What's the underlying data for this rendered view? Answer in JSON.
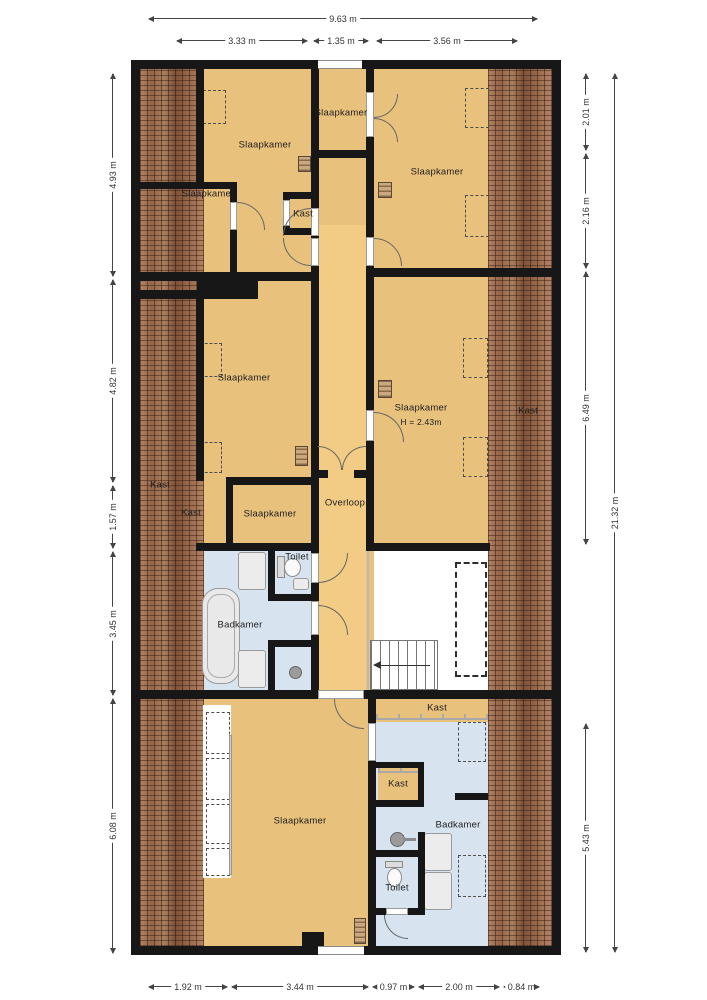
{
  "colors": {
    "wall": "#171717",
    "floor": "#e8c17c",
    "corridor": "#f2cb85",
    "bath": "#d7e4f0",
    "roof": "#96684c",
    "dim": "#444444"
  },
  "plan": {
    "labels": [
      {
        "id": "slaapkamer-top-left",
        "text": "Slaapkamer",
        "x": 265,
        "y": 145
      },
      {
        "id": "slaapkamer-top-center",
        "text": "Slaapkamer",
        "x": 341,
        "y": 113
      },
      {
        "id": "slaapkamer-top-right",
        "text": "Slaapkamer",
        "x": 437,
        "y": 172
      },
      {
        "id": "slaapkamer-left-small",
        "text": "Slaapkamer",
        "x": 208,
        "y": 194
      },
      {
        "id": "kast-top-center",
        "text": "Kast",
        "x": 303,
        "y": 214
      },
      {
        "id": "slaapkamer-mid-left",
        "text": "Slaapkamer",
        "x": 244,
        "y": 378
      },
      {
        "id": "slaapkamer-mid-right",
        "text": "Slaapkamer",
        "x": 421,
        "y": 408
      },
      {
        "id": "height-mid-right",
        "text": "H = 2.43m",
        "x": 421,
        "y": 422,
        "small": true
      },
      {
        "id": "kast-mid-right",
        "text": "Kast",
        "x": 528,
        "y": 411
      },
      {
        "id": "kast-left-roof",
        "text": "Kast",
        "x": 160,
        "y": 485
      },
      {
        "id": "kast-left",
        "text": "Kast",
        "x": 191,
        "y": 513
      },
      {
        "id": "slaapkamer-center-small",
        "text": "Slaapkamer",
        "x": 270,
        "y": 514
      },
      {
        "id": "overloop",
        "text": "Overloop",
        "x": 345,
        "y": 503
      },
      {
        "id": "toilet-mid",
        "text": "Toilet",
        "x": 297,
        "y": 557
      },
      {
        "id": "badkamer-mid",
        "text": "Badkamer",
        "x": 240,
        "y": 625
      },
      {
        "id": "kast-bottom-strip",
        "text": "Kast",
        "x": 437,
        "y": 708
      },
      {
        "id": "kast-bottom-small",
        "text": "Kast",
        "x": 398,
        "y": 784
      },
      {
        "id": "slaapkamer-bottom",
        "text": "Slaapkamer",
        "x": 300,
        "y": 821
      },
      {
        "id": "badkamer-bottom",
        "text": "Badkamer",
        "x": 458,
        "y": 825
      },
      {
        "id": "toilet-bottom",
        "text": "Toilet",
        "x": 397,
        "y": 888
      }
    ],
    "legend_note": "Overloop = landing, Slaapkamer = bedroom, Badkamer = bathroom, Kast = closet"
  },
  "dimensions": {
    "top": [
      {
        "text": "9.63 m",
        "x1": 148,
        "x2": 538,
        "y": 18
      },
      {
        "text": "3.33 m",
        "x1": 176,
        "x2": 308,
        "y": 40
      },
      {
        "text": "1.35 m",
        "x1": 313,
        "x2": 369,
        "y": 40
      },
      {
        "text": "3.56 m",
        "x1": 376,
        "x2": 518,
        "y": 40
      }
    ],
    "bottom": [
      {
        "text": "1.92 m",
        "x1": 148,
        "x2": 228,
        "y": 986
      },
      {
        "text": "3.44 m",
        "x1": 231,
        "x2": 369,
        "y": 986
      },
      {
        "text": "0.97 m",
        "x1": 372,
        "x2": 415,
        "y": 986
      },
      {
        "text": "2.00 m",
        "x1": 418,
        "x2": 500,
        "y": 986
      },
      {
        "text": "0.84 m",
        "x1": 503,
        "x2": 540,
        "y": 986
      }
    ],
    "left": [
      {
        "text": "4.93 m",
        "y1": 73,
        "y2": 277,
        "x": 112
      },
      {
        "text": "4.82 m",
        "y1": 279,
        "y2": 483,
        "x": 112
      },
      {
        "text": "1.57 m",
        "y1": 485,
        "y2": 549,
        "x": 112
      },
      {
        "text": "3.45 m",
        "y1": 551,
        "y2": 696,
        "x": 112
      },
      {
        "text": "6.08 m",
        "y1": 698,
        "y2": 954,
        "x": 112
      }
    ],
    "right": [
      {
        "text": "2.01 m",
        "y1": 73,
        "y2": 151,
        "x": 585
      },
      {
        "text": "2.16 m",
        "y1": 153,
        "y2": 269,
        "x": 585
      },
      {
        "text": "6.49 m",
        "y1": 271,
        "y2": 545,
        "x": 585
      },
      {
        "text": "5.43 m",
        "y1": 723,
        "y2": 953,
        "x": 585
      },
      {
        "text": "21.32 m",
        "y1": 73,
        "y2": 953,
        "x": 614
      }
    ]
  }
}
